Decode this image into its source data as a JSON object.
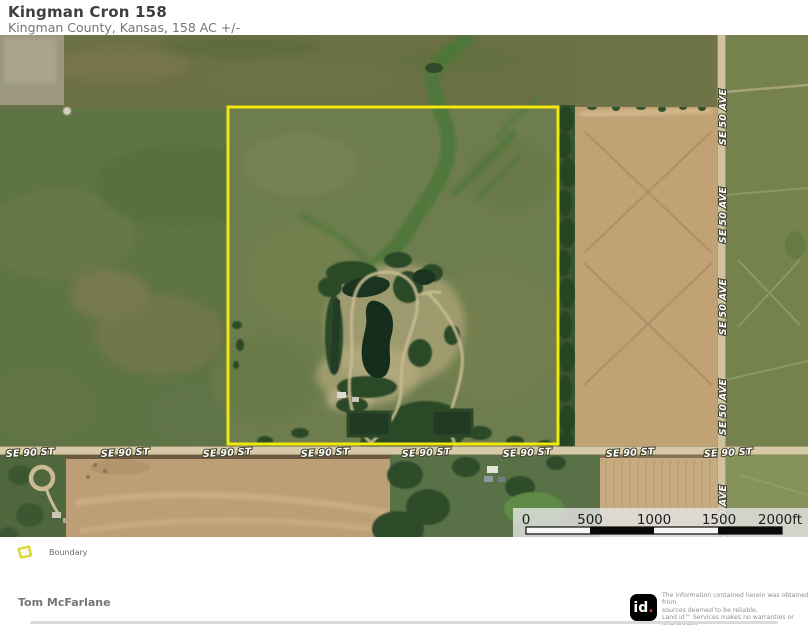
{
  "header": {
    "title": "Kingman Cron 158",
    "subtitle": "Kingman County, Kansas, 158 AC +/-"
  },
  "map": {
    "h_road_label": "SE 90 ST",
    "v_road_label": "SE 50 AVE",
    "boundary_color": "#f2e70e",
    "scale_bar": {
      "ticks": [
        "0",
        "500",
        "1000",
        "1500"
      ],
      "end_label": "2000ft"
    }
  },
  "legend": {
    "boundary_label": "Boundary",
    "boundary_icon_color": "#dcd637"
  },
  "footer": {
    "author": "Tom McFarlane",
    "logo_text": "id",
    "logo_dot": ".",
    "disclaimer_line1": "The information contained herein was obtained from",
    "disclaimer_line2": "sources deemed to be reliable.",
    "disclaimer_line3": " Land id™ Services makes no warranties or guarantees",
    "disclaimer_line4": "as to the completeness or accuracy thereof."
  }
}
